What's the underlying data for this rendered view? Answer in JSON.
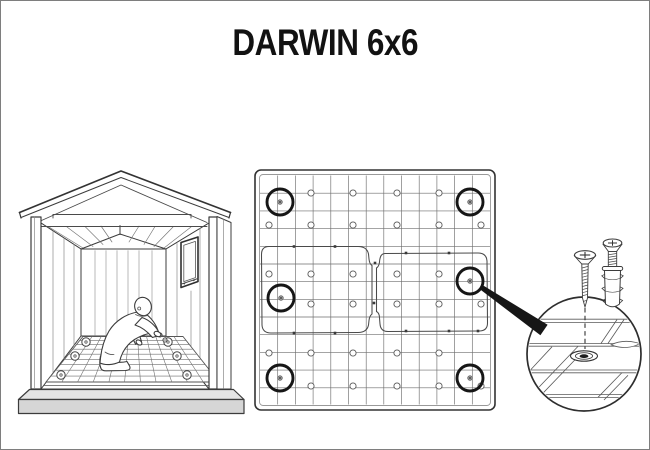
{
  "title": "DARWIN 6x6",
  "colors": {
    "ink": "#3c3c3c",
    "ink_dark": "#161616",
    "ink_light": "#7a7a7a",
    "grid_line": "#6e6e6e",
    "base_top": "#e4e4e4",
    "base_front": "#d6d6d6",
    "page_border": "#7e7e7e",
    "background": "#ffffff"
  },
  "shed_view": {
    "floor_anchors": [
      [
        60,
        374
      ],
      [
        74,
        355
      ],
      [
        85,
        341
      ],
      [
        186,
        374
      ],
      [
        176,
        355
      ],
      [
        167,
        341
      ]
    ],
    "loose_screws": [
      [
        159,
        334
      ],
      [
        164,
        339
      ]
    ]
  },
  "floor_view": {
    "frame": {
      "x": 254,
      "y": 169,
      "size": 240,
      "radius": 6
    },
    "grid": {
      "x0": 259,
      "y0": 174.5,
      "x1": 489,
      "y1": 403.5,
      "lines": 12
    },
    "hole_radius": 3.1,
    "hole_rows": [
      {
        "y": 192,
        "xs": [
          310,
          352,
          396,
          438
        ]
      },
      {
        "y": 224,
        "xs": [
          268,
          310,
          352,
          396,
          438,
          480
        ]
      },
      {
        "y": 273,
        "xs": [
          268,
          310,
          352,
          396,
          438
        ]
      },
      {
        "y": 303,
        "xs": [
          310,
          352,
          396,
          438,
          480
        ]
      },
      {
        "y": 352,
        "xs": [
          268,
          310,
          352,
          396,
          438
        ]
      },
      {
        "y": 385,
        "xs": [
          310,
          352,
          396,
          438,
          480
        ]
      }
    ],
    "anchors": {
      "radius": 13,
      "points": [
        [
          279,
          201
        ],
        [
          469,
          201
        ],
        [
          280,
          297
        ],
        [
          469,
          280
        ],
        [
          279,
          377
        ],
        [
          469,
          377
        ]
      ]
    },
    "seam_ticks": [
      [
        293,
        245.5
      ],
      [
        334,
        245.5
      ],
      [
        405,
        252
      ],
      [
        448,
        252
      ],
      [
        293,
        332
      ],
      [
        334,
        332
      ],
      [
        405,
        330
      ],
      [
        448,
        330
      ],
      [
        477,
        330
      ],
      [
        374,
        262
      ],
      [
        373,
        302
      ]
    ],
    "callout_arrow": {
      "from": [
        480,
        286
      ],
      "to": [
        543,
        329
      ],
      "w0": 2.4,
      "w1": 6.4
    }
  },
  "detail_view": {
    "magnifier": {
      "cx": 583,
      "cy": 353,
      "r": 57
    },
    "dashed_line": {
      "x": 584,
      "y1": 307,
      "y2": 348
    }
  }
}
